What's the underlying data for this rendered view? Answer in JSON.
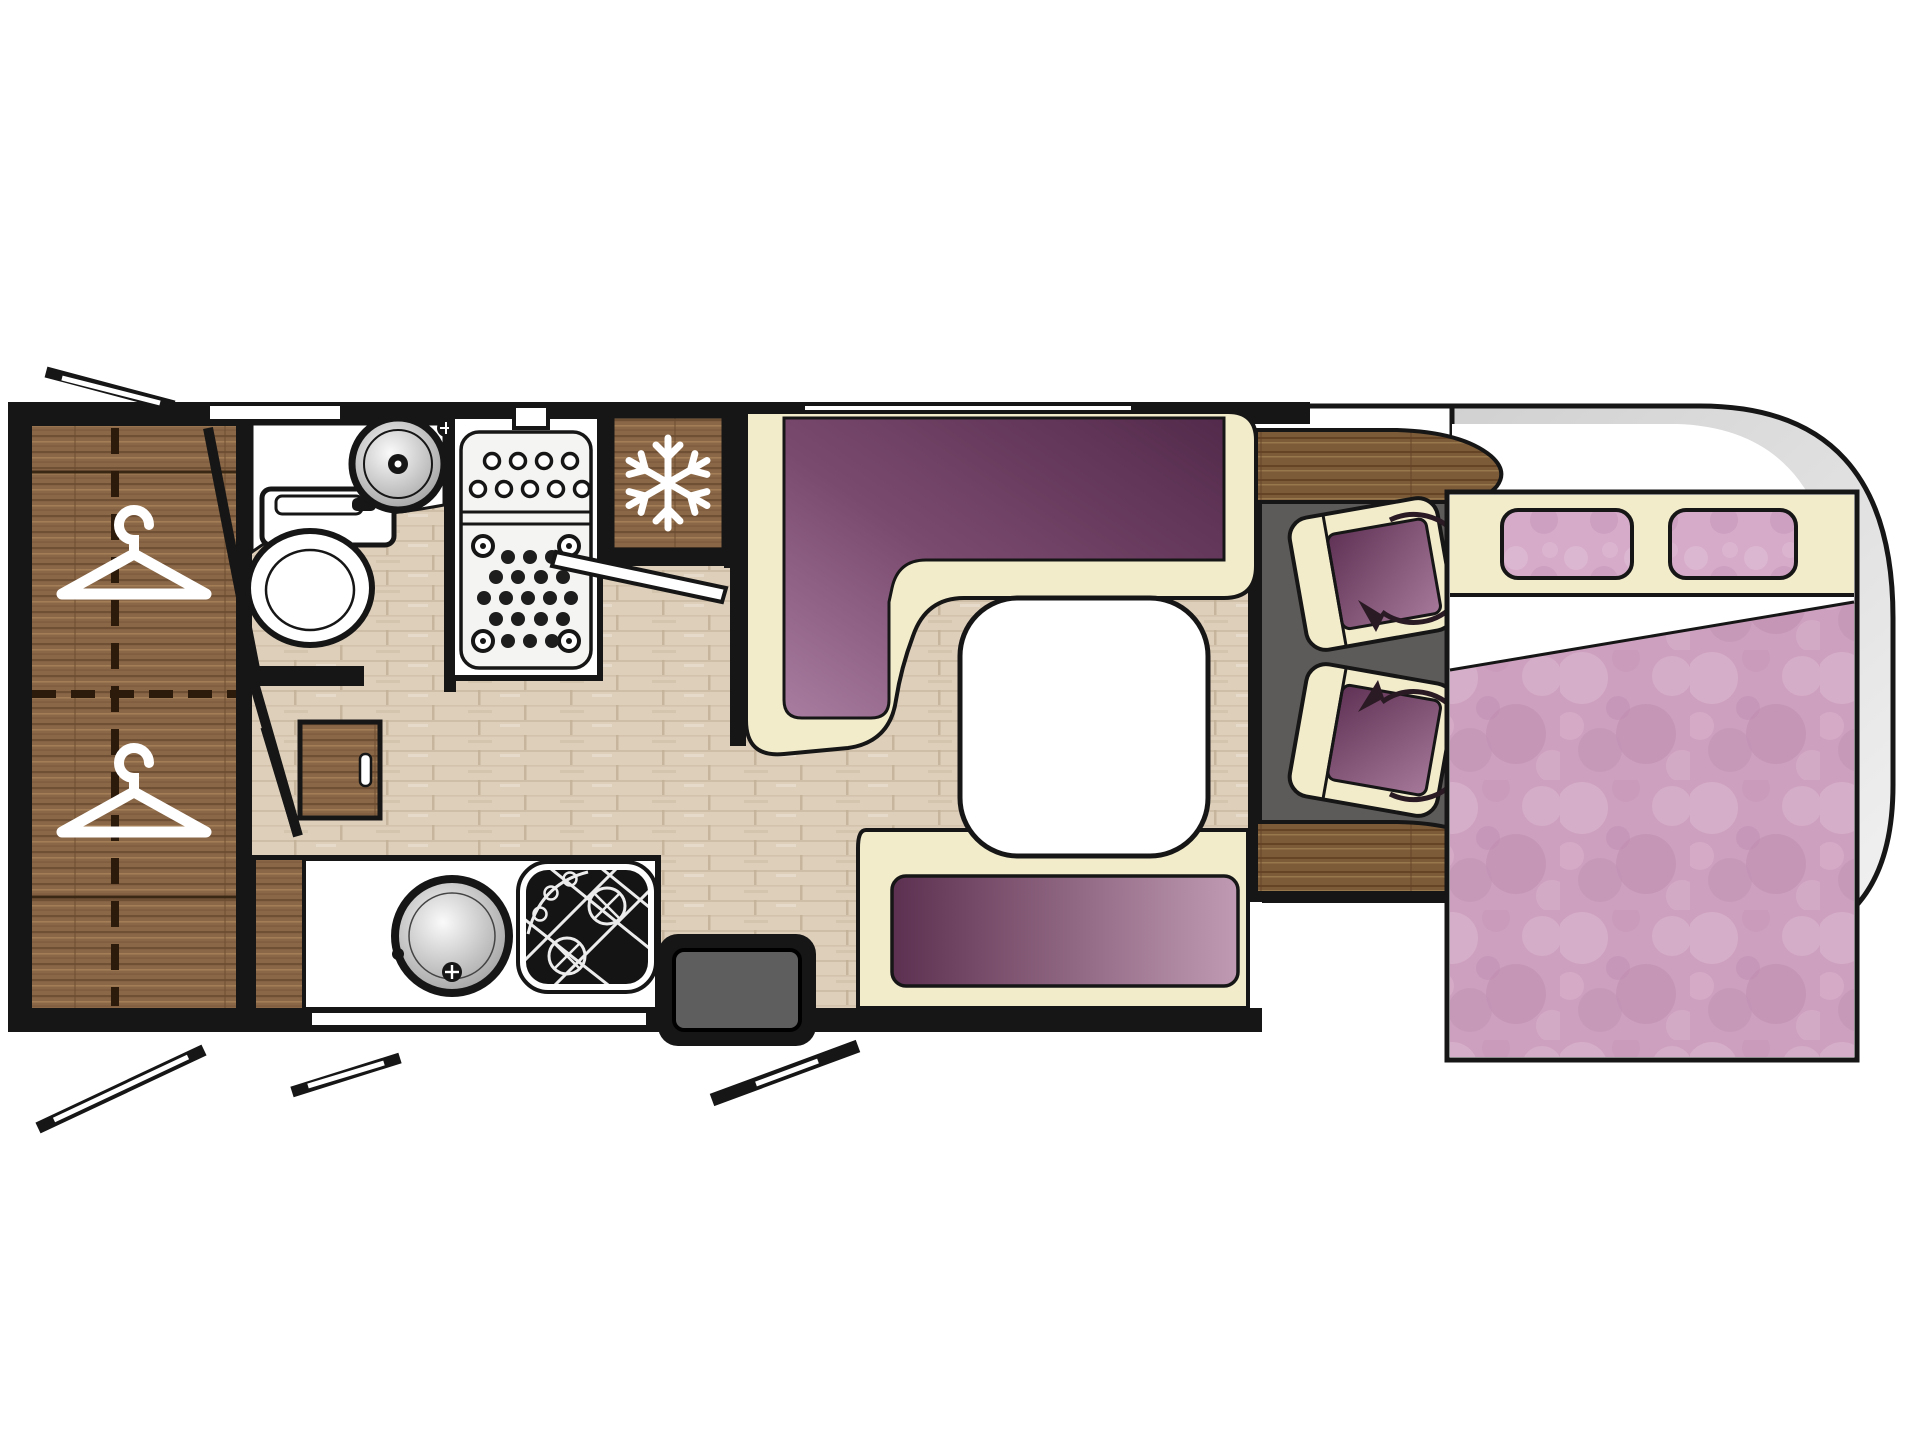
{
  "diagram": {
    "kind": "motorhome-floor-plan",
    "orientation": "side-profile-top-view, rear at left, cab at right",
    "zones": [
      {
        "name": "rear-wardrobe",
        "icons": [
          "hanger-icon",
          "hanger-icon"
        ],
        "hanger_count": 2
      },
      {
        "name": "washroom",
        "fixtures": [
          "toilet",
          "washbasin",
          "vanity-counter",
          "hinged-door"
        ]
      },
      {
        "name": "shower-cubicle",
        "fixtures": [
          "shower-tray",
          "drain-holes"
        ]
      },
      {
        "name": "kitchen",
        "fixtures": [
          "refrigerator",
          "round-sink",
          "hob-burners",
          "worktop",
          "base-cabinet",
          "side-desk"
        ],
        "fridge_icon": "snowflake-icon"
      },
      {
        "name": "entrance",
        "fixtures": [
          "entry-step",
          "open-entry-door"
        ]
      },
      {
        "name": "dinette",
        "fixtures": [
          "l-shaped-bench",
          "pedestal-table",
          "side-bench"
        ]
      },
      {
        "name": "cab",
        "fixtures": [
          "dashboard-trim",
          "cab-door-trim",
          "swivel-seat",
          "swivel-seat"
        ],
        "seat_count": 2,
        "swivel_icon": "rotate-arrow-icon"
      },
      {
        "name": "drop-down-bed",
        "fixtures": [
          "headboard-shelf",
          "pillow",
          "pillow",
          "mattress",
          "folded-sheet"
        ],
        "pillow_count": 2
      }
    ],
    "window_slot_count": 2,
    "exterior_flap_count": 4
  },
  "colors": {
    "background": "#ffffff",
    "wall": "#161616",
    "floor": "#ddcfba",
    "floor_line": "#c2b096",
    "wood": "#8a6747",
    "wood_streak_dark": "#6b4c30",
    "wood_streak_light": "#a58057",
    "dash_wood": "#7c5b39",
    "cream": "#f3eccb",
    "plum_dark": "#532a4b",
    "plum_light": "#a87da0",
    "bench_plum_dark": "#5c3050",
    "bench_plum_light": "#c09ab2",
    "seat_plum_dark": "#5f3255",
    "seat_plum_light": "#a67899",
    "bed_pink": "#cda0bf",
    "bed_pink_light": "#dcb9d1",
    "pillow_pink": "#d5abc9",
    "cab_floor": "#5d5b59",
    "body_gray": "#cccccc",
    "body_gray_light": "#f2f2f2",
    "sink_gray": "#969696",
    "arrow": "#2a1a24",
    "white": "#ffffff"
  }
}
